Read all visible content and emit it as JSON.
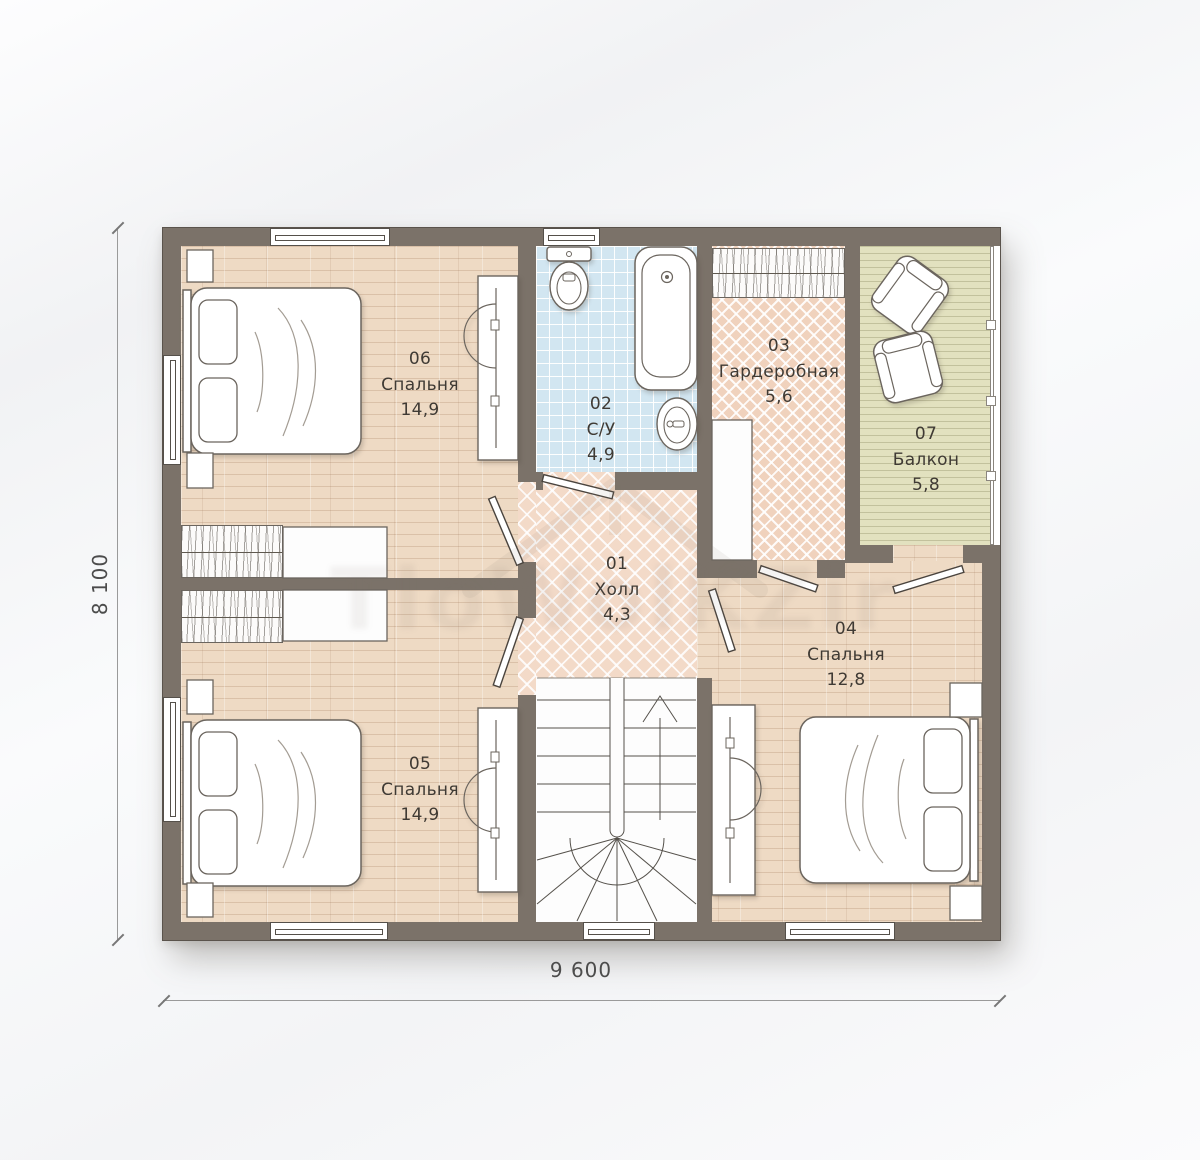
{
  "plan": {
    "rooms": {
      "r01": {
        "number": "01",
        "name": "Холл",
        "area": "4,3"
      },
      "r02": {
        "number": "02",
        "name": "С/У",
        "area": "4,9"
      },
      "r03": {
        "number": "03",
        "name": "Гардеробная",
        "area": "5,6"
      },
      "r04": {
        "number": "04",
        "name": "Спальня",
        "area": "12,8"
      },
      "r05": {
        "number": "05",
        "name": "Спальня",
        "area": "14,9"
      },
      "r06": {
        "number": "06",
        "name": "Спальня",
        "area": "14,9"
      },
      "r07": {
        "number": "07",
        "name": "Балкон",
        "area": "5,8"
      }
    },
    "dimensions": {
      "bottom": "9 600",
      "left": "8 100"
    },
    "watermark": {
      "text": "TloWolKZir"
    },
    "colors": {
      "wall": "#7b7269",
      "wood_floor": "#eedac4",
      "herringbone_hall": "#f3dac8",
      "herringbone_wardrobe": "#f0d2bd",
      "bathroom_tile": "#d2e6f1",
      "balcony_deck": "#e2e1bf",
      "text": "#3f3a34"
    }
  }
}
